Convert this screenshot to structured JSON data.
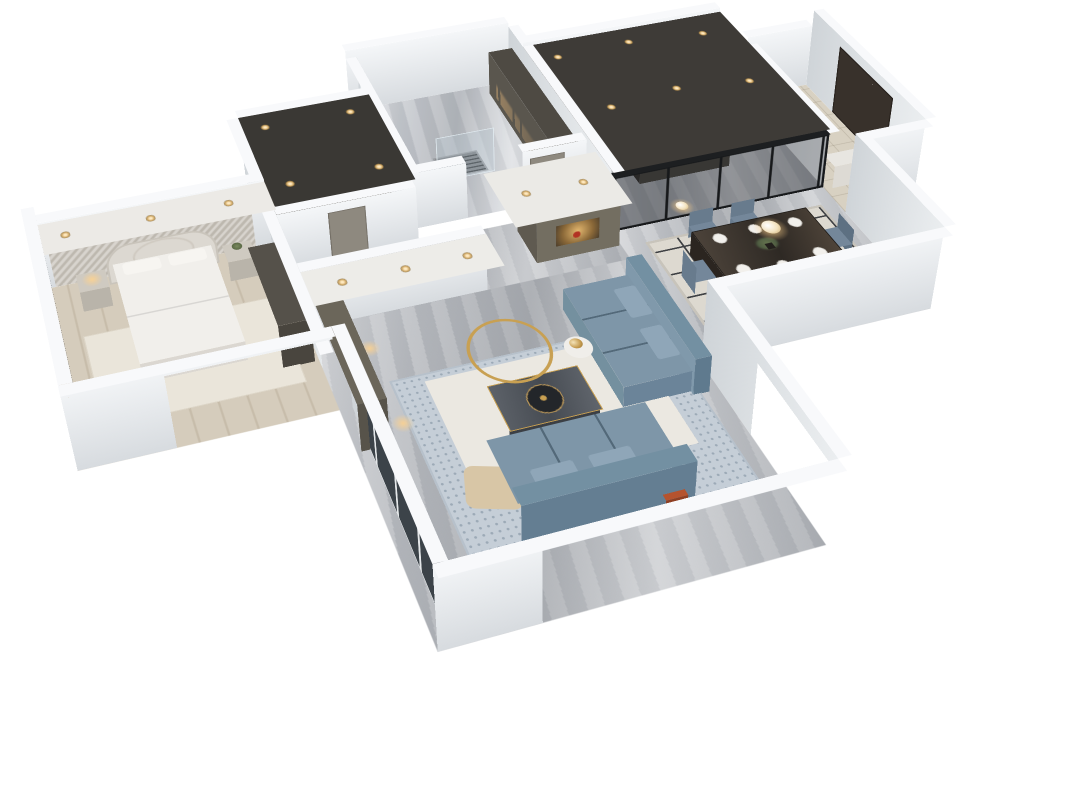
{
  "scene": {
    "type": "3d-apartment-floorplan-render",
    "description": "Bird's-eye cutaway render of a furnished modern apartment with white cut walls on a white background",
    "background": "#ffffff",
    "tv_screen_text": "E N H A N C E"
  },
  "palette": {
    "wall_top": "#f8f9fb",
    "wall_face": "#eef0f3",
    "exterior_gray": "#d3d4d6",
    "marble_floor": "#b7babf",
    "wood_floor": "#d5ccbc",
    "cabinet_olive": "#6b665a",
    "cabinet_dark": "#4a463f",
    "sofa_blue": "#7e96a8",
    "rug_cream": "#ebe8e1",
    "rug_blue": "#c5ced7",
    "gold_accent": "#c8a052",
    "glass_dark": "#17191c",
    "warm_light": "#ffd28c",
    "red_accent": "#b23324"
  },
  "rooms": [
    {
      "id": "master-bedroom",
      "label": "Master Bedroom",
      "furniture": [
        "upholstered bed",
        "quilted arched headboard",
        "textured accent wall with cove lighting",
        "two nightstands",
        "table lamp",
        "plant",
        "dark wardrobe",
        "floor-to-ceiling tinted window",
        "ceiling strip with downlights"
      ]
    },
    {
      "id": "walk-in-closet",
      "label": "Walk-in Closet",
      "furniture": [
        "open shelving unit",
        "dark ceiling with recessed spotlights"
      ]
    },
    {
      "id": "bathroom-laundry",
      "label": "Bathroom / Laundry",
      "furniture": [
        "sheer curtain wall",
        "floor drain grate",
        "glass shower panel",
        "lit wardrobe cabinet"
      ]
    },
    {
      "id": "hallway",
      "label": "Hallway",
      "furniture": [
        "display cabinet with lit niche",
        "red decor vase",
        "interior doors",
        "ceiling downlights"
      ]
    },
    {
      "id": "kitchen",
      "label": "Kitchen",
      "furniture": [
        "dark cabinet run with wine niche",
        "under-cabinet lighting",
        "island counter",
        "pendant lights",
        "black-framed glass partition",
        "dark ceiling with spotlights"
      ]
    },
    {
      "id": "entry",
      "label": "Entry",
      "furniture": [
        "dark entry door",
        "shoe cabinet"
      ]
    },
    {
      "id": "dining-room",
      "label": "Dining Room",
      "furniture": [
        "dark wood dining table",
        "six slate-blue chairs",
        "white place settings",
        "plant centerpiece",
        "geometric lattice rug",
        "glowing pendant lights",
        "floor plant"
      ]
    },
    {
      "id": "living-room",
      "label": "Living Room",
      "furniture": [
        "two slate-blue fabric sofas",
        "dark marble coffee table with gold trim",
        "round gold decor ring",
        "TV media wall with shelving",
        "TV screen",
        "round side table with lamp",
        "beige lounge chair",
        "magazine rack",
        "two-tone rug",
        "glazed window wall",
        "ceiling strip with downlights"
      ]
    }
  ]
}
